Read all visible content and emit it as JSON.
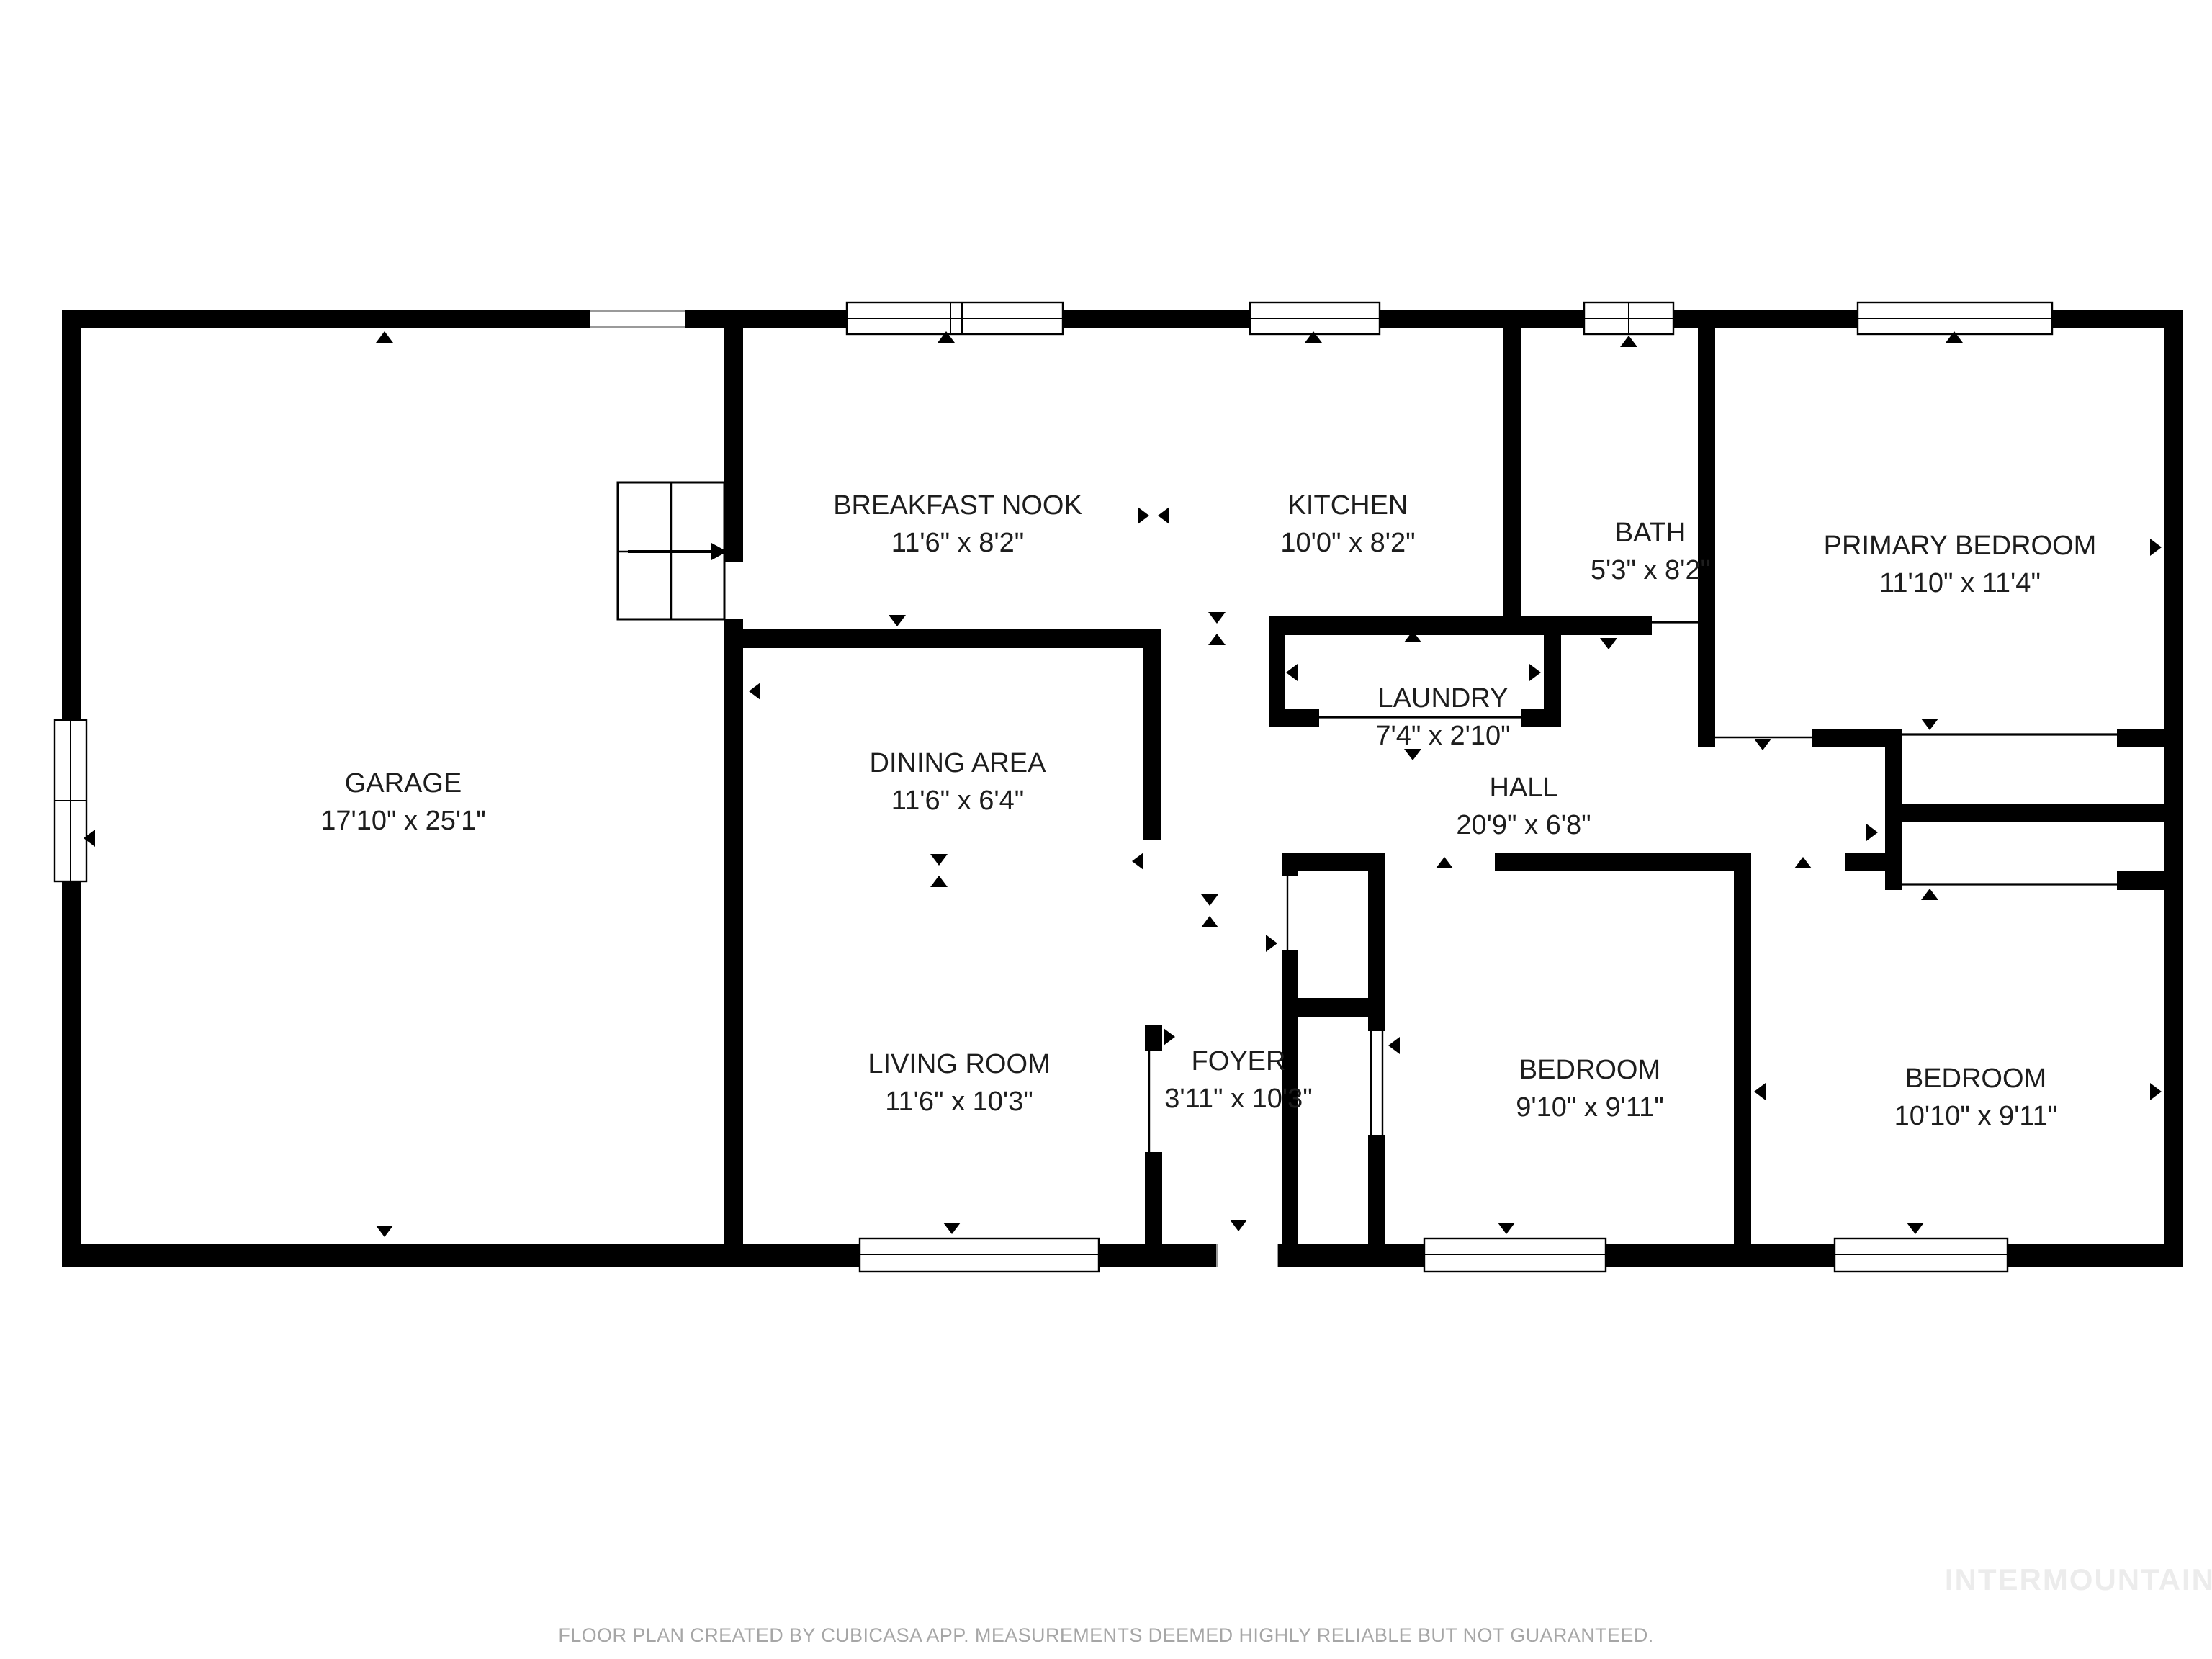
{
  "title": "Floor plan",
  "footer": {
    "disclaimer": "FLOOR PLAN CREATED BY CUBICASA APP. MEASUREMENTS DEEMED HIGHLY RELIABLE BUT NOT GUARANTEED.",
    "watermark": "INTERMOUNTAIN"
  },
  "colors": {
    "wall": "#000000",
    "room_text": "#1d1d1d",
    "footer_text": "#a6a6a6",
    "watermark_text": "#ececec",
    "background": "#ffffff"
  },
  "rooms": [
    {
      "name": "GARAGE",
      "dimensions": "17'10\" x 25'1\""
    },
    {
      "name": "BREAKFAST NOOK",
      "dimensions": "11'6\" x 8'2\""
    },
    {
      "name": "KITCHEN",
      "dimensions": "10'0\" x 8'2\""
    },
    {
      "name": "BATH",
      "dimensions": "5'3\" x 8'2\""
    },
    {
      "name": "PRIMARY BEDROOM",
      "dimensions": "11'10\" x 11'4\""
    },
    {
      "name": "DINING AREA",
      "dimensions": "11'6\" x 6'4\""
    },
    {
      "name": "LAUNDRY",
      "dimensions": "7'4\" x 2'10\""
    },
    {
      "name": "HALL",
      "dimensions": "20'9\" x 6'8\""
    },
    {
      "name": "LIVING ROOM",
      "dimensions": "11'6\" x 10'3\""
    },
    {
      "name": "FOYER",
      "dimensions": "3'11\" x 10'3\""
    },
    {
      "name": "BEDROOM",
      "dimensions": "9'10\" x 9'11\""
    },
    {
      "name": "BEDROOM",
      "dimensions": "10'10\" x 9'11\""
    }
  ],
  "icons": {
    "stairs": "stairs-with-direction-arrow",
    "door_arrow": "door-direction-triangle",
    "window": "double-line-window-symbol"
  }
}
